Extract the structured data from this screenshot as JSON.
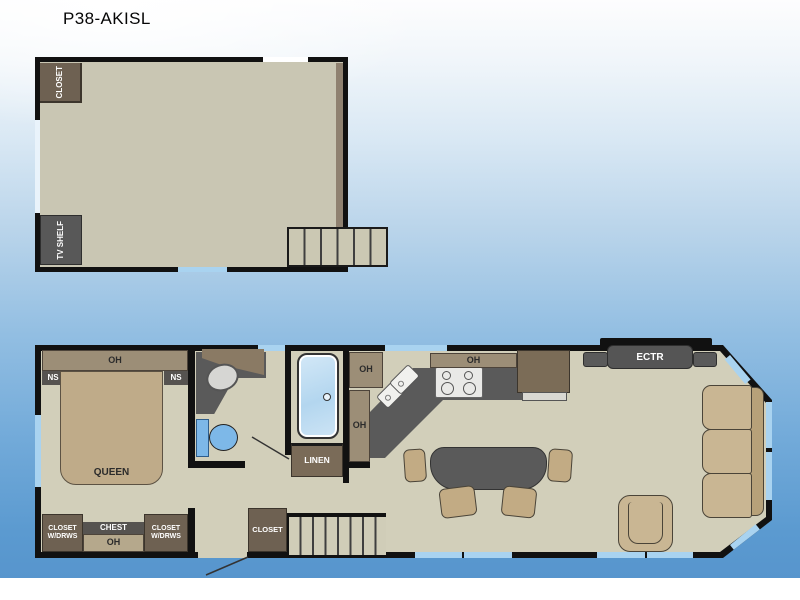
{
  "title": "P38-AKISL",
  "colors": {
    "wall": "#111111",
    "floor": "#d2cfba",
    "loft_floor": "#c9c6b3",
    "window_blue": "#a9d3f0",
    "cabinet_brown": "#6e6152",
    "cabinet_tan": "#9c8e77",
    "counter_gray": "#5a5a5a",
    "furniture_tan": "#c2ab84",
    "fixture_blue": "#7db8e8",
    "sky_blue": "#5795cd"
  },
  "loft": {
    "closet_label": "CLOSET",
    "tv_shelf_label": "TV SHELF"
  },
  "main_floor": {
    "bedroom": {
      "oh_label": "OH",
      "ns_left_label": "NS",
      "ns_right_label": "NS",
      "bed_label": "QUEEN",
      "closet_left_line1": "CLOSET",
      "closet_left_line2": "W/DRWS",
      "chest_label": "CHEST",
      "chest_oh_label": "OH",
      "closet_right_line1": "CLOSET",
      "closet_right_line2": "W/DRWS"
    },
    "bathroom": {
      "linen_label": "LINEN"
    },
    "kitchen": {
      "oh_corner_label": "OH",
      "oh_column_label": "OH",
      "oh_top_label": "OH"
    },
    "entry": {
      "closet_label": "CLOSET"
    },
    "living": {
      "ectr_label": "ECTR"
    }
  }
}
